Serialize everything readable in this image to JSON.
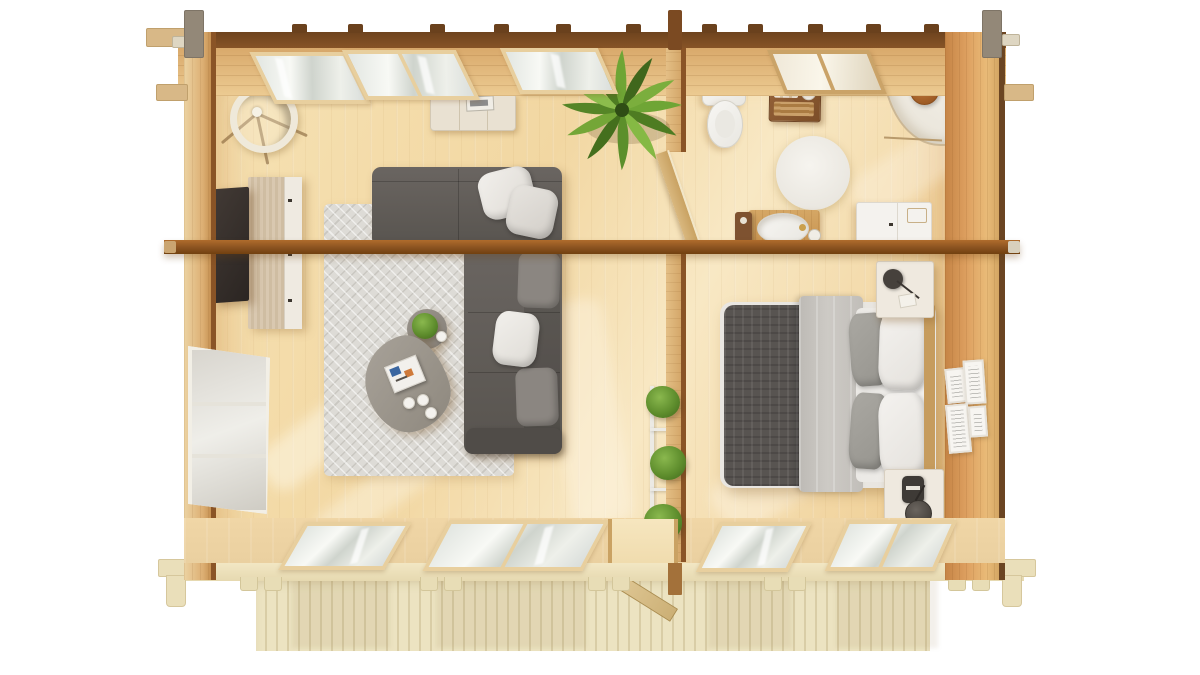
{
  "scene": {
    "type": "3d-top-view-floor-plan-render",
    "background": "#ffffff",
    "rooms": [
      {
        "name": "living-room",
        "items": [
          "corner-sofa",
          "white-pillows",
          "area-rug",
          "organic-coffee-table",
          "open-book",
          "coffee-cups",
          "round-side-table-with-plant",
          "floor-lamp",
          "desk",
          "desk-cabinet",
          "laptop",
          "sideboard",
          "wall-mounted-tv",
          "palm-plant",
          "wall-windows"
        ]
      },
      {
        "name": "bathroom",
        "items": [
          "toilet",
          "wooden-storage-crate",
          "corner-shower",
          "shower-head",
          "round-bath-mat",
          "washbasin-vanity",
          "waste-bin",
          "toilet-brush",
          "white-cabinet"
        ]
      },
      {
        "name": "bedroom",
        "items": [
          "double-bed",
          "knit-blanket",
          "gray-throw",
          "white-duvet",
          "pillows",
          "headboard",
          "nightstand-with-lamp-top",
          "nightstand-with-lamp-bottom",
          "picture-frames",
          "plant-stand"
        ]
      },
      {
        "name": "terrace",
        "items": [
          "deck-boards",
          "open-entrance-door",
          "joist-tabs",
          "corner-brackets"
        ]
      }
    ],
    "structure": [
      "log-walls",
      "center-roof-beam",
      "partition-wall",
      "partition-door",
      "corner-log-ends",
      "rafter-tabs"
    ]
  },
  "palette": {
    "wall-dark": "#6e431e",
    "wall-tan": "#d9a96b",
    "wall-edge": "#8a5426",
    "beam-top": "#b06c2c",
    "beam-bottom": "#71400f",
    "floor": "#f6e2b4",
    "floor-warm": "#eecb8e",
    "deck": "#ece3c1",
    "deck-line": "#d9cda6",
    "rug": "#dddbd6",
    "sofa": "#58544f",
    "blanket": "#585451",
    "pillow-white": "#f1efeb",
    "pillow-gray": "#a3a19b",
    "plant-green": "#6fa535",
    "plant-green-dark": "#4e7c22",
    "porcelain": "#f5f4f1",
    "terracotta": "#b06a35",
    "tv-black": "#332c28",
    "desk-walnut": "#6f4a37"
  }
}
